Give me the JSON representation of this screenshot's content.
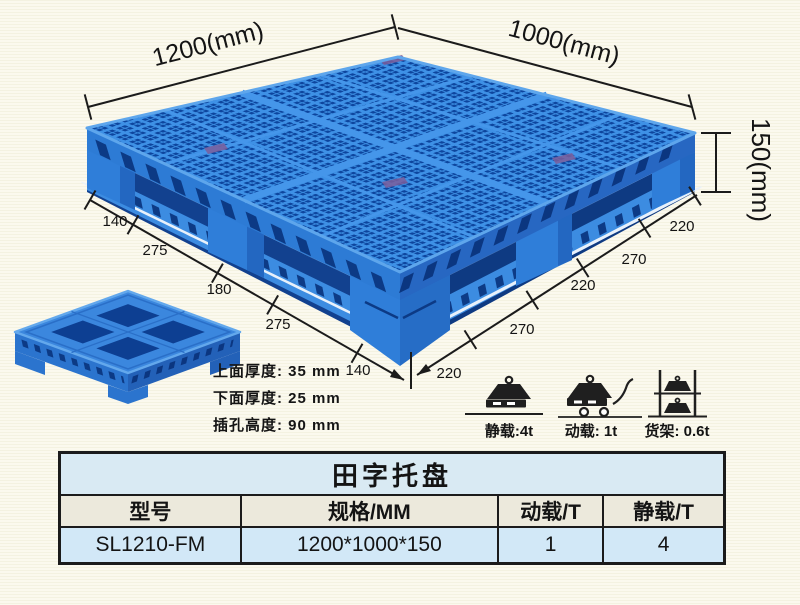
{
  "dimensions": {
    "width_label": "1200(mm)",
    "depth_label": "1000(mm)",
    "height_label": "150(mm)",
    "left_chain": [
      "140",
      "275",
      "180",
      "275",
      "140"
    ],
    "right_chain": [
      "220",
      "270",
      "220",
      "270",
      "220"
    ]
  },
  "thickness_specs": [
    "上面厚度: 35 mm",
    "下面厚度: 25 mm",
    "插孔高度: 90 mm"
  ],
  "load_ratings": [
    {
      "icon": "static-load-icon",
      "label": "静载:4t"
    },
    {
      "icon": "dynamic-load-icon",
      "label": "动载: 1t"
    },
    {
      "icon": "rack-load-icon",
      "label": "货架: 0.6t"
    }
  ],
  "spec_table": {
    "title": "田字托盘",
    "headers": [
      "型号",
      "规格/MM",
      "动载/T",
      "静载/T"
    ],
    "row": [
      "SL1210-FM",
      "1200*1000*150",
      "1",
      "4"
    ]
  },
  "colors": {
    "pallet_rib": "#3e91e6",
    "pallet_hole": "#0d459e",
    "pallet_face": "#2e7dd8",
    "ink": "#1b1b1b",
    "table_title_bg": "#d9eaf3",
    "table_header_bg": "#ece9dc",
    "table_data_bg": "#d2e8f7"
  }
}
